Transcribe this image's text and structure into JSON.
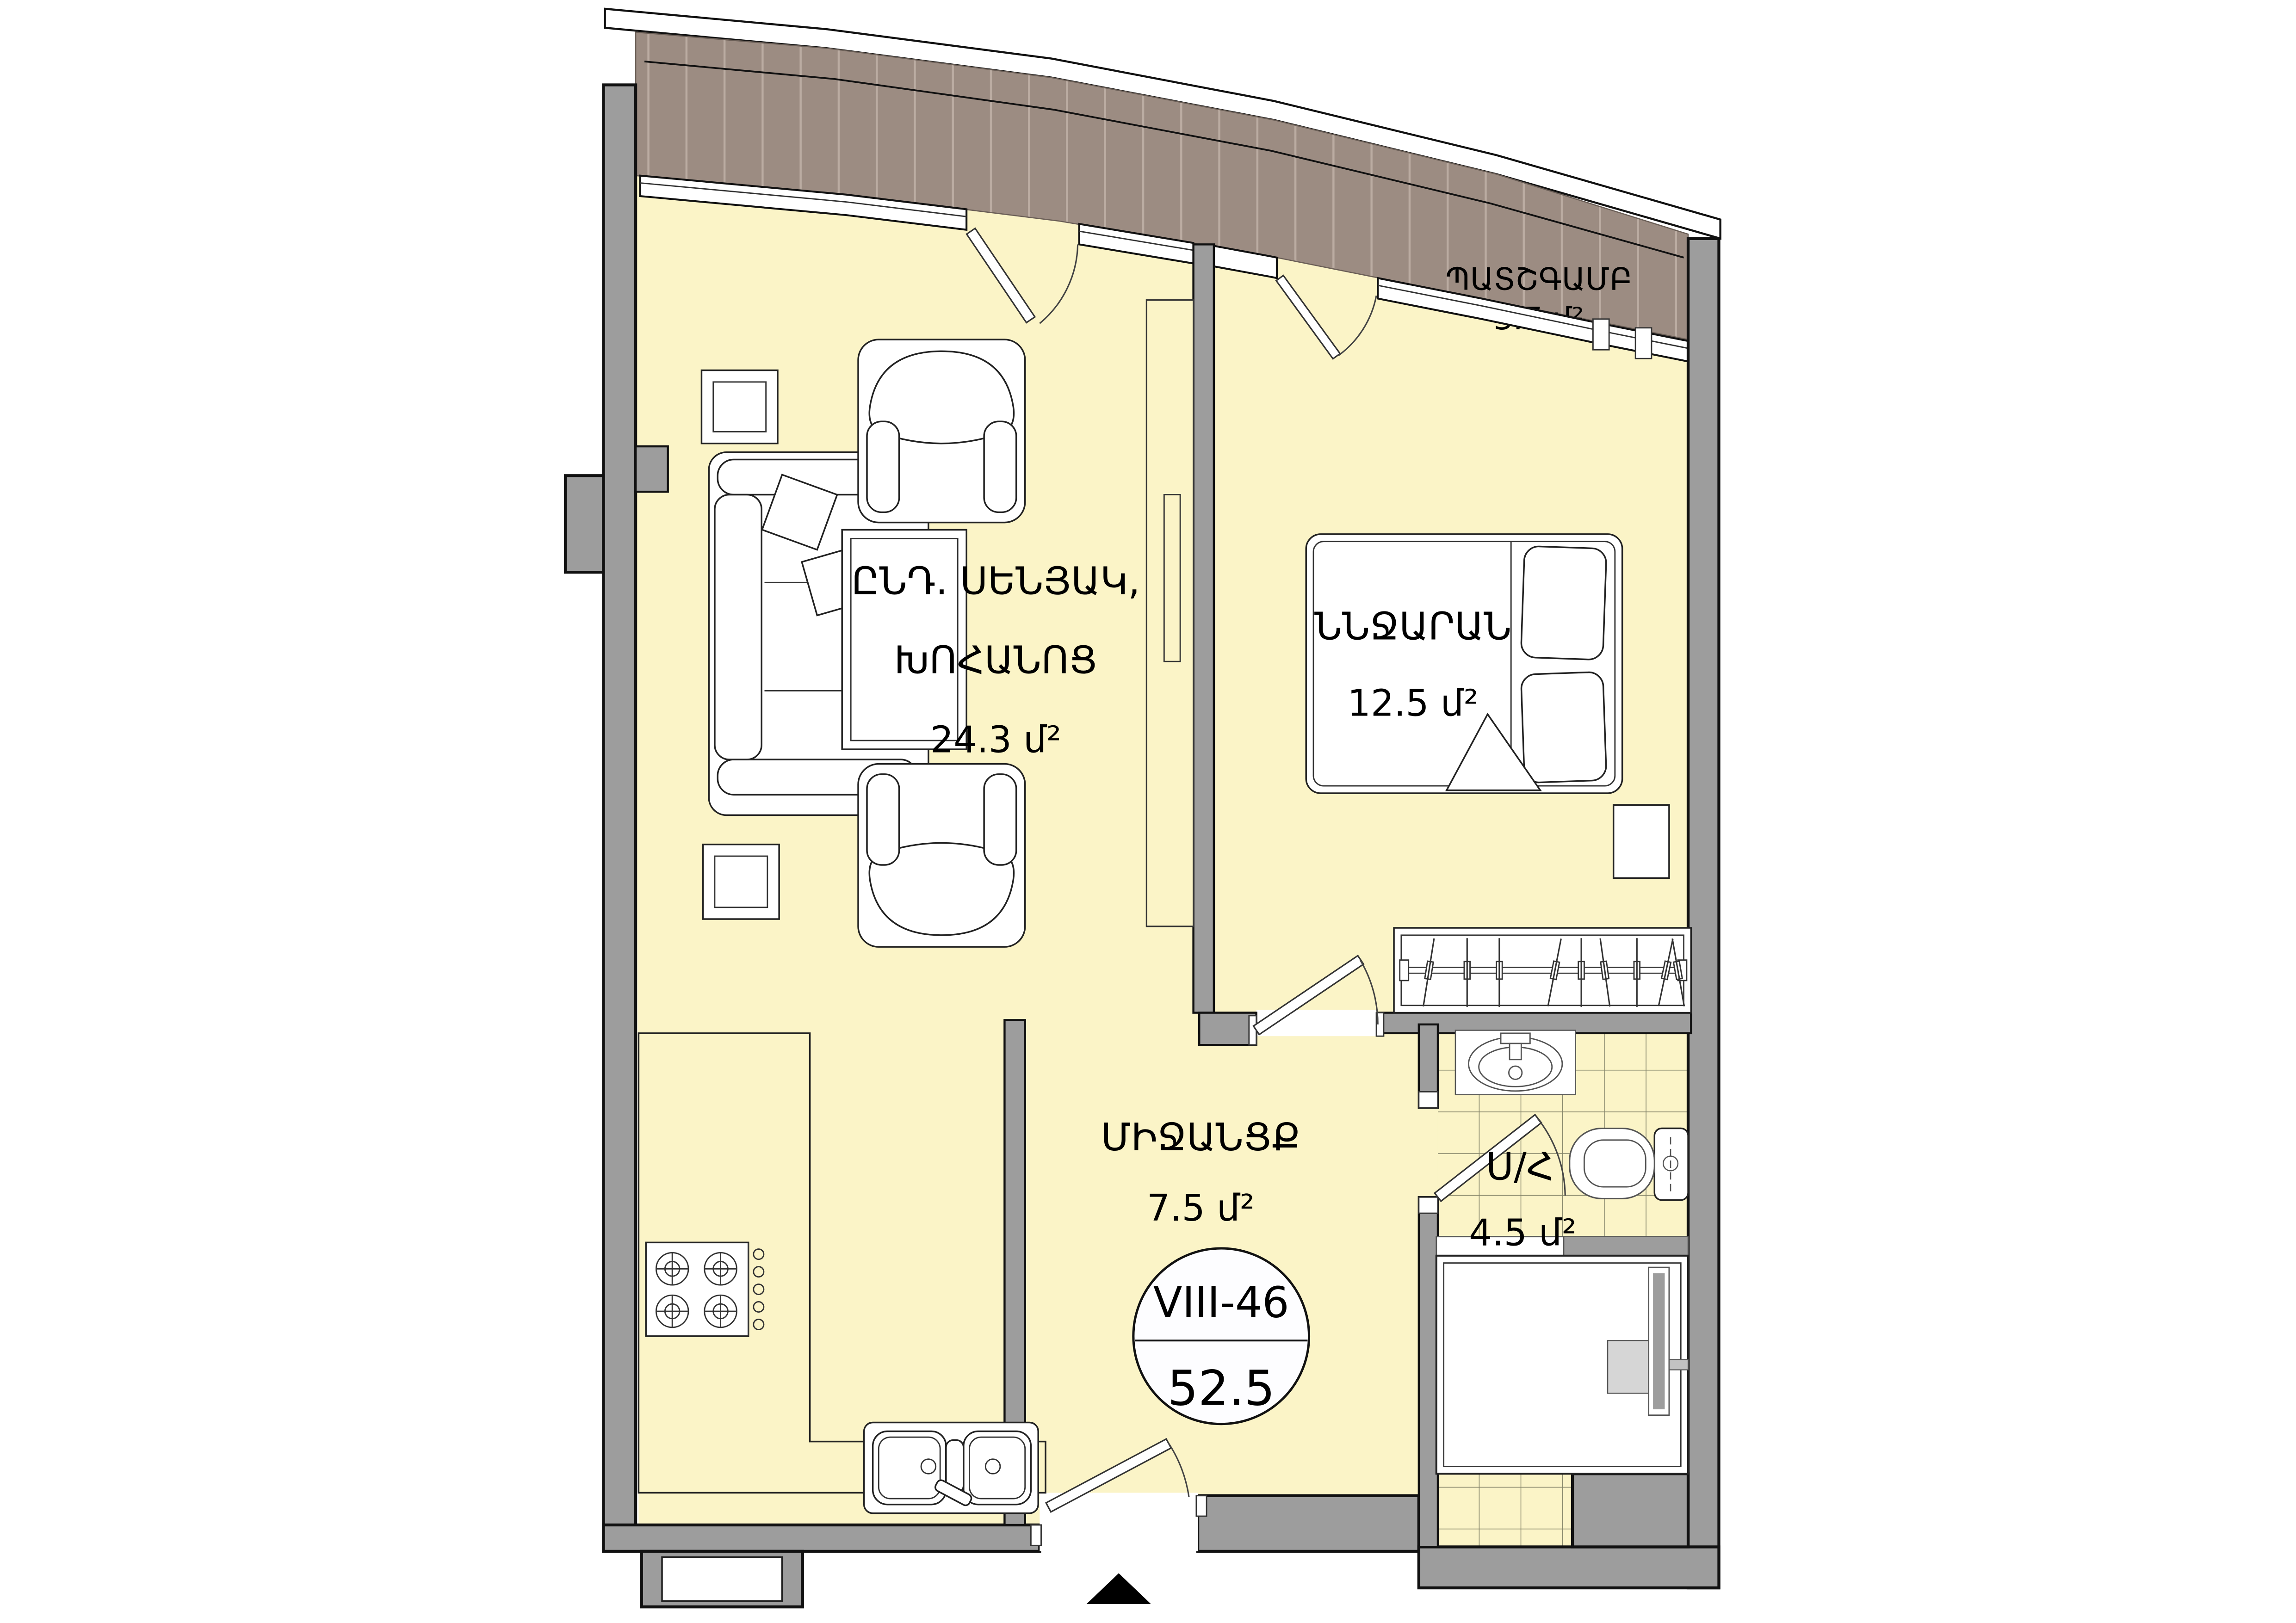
{
  "plan": {
    "title": "Apartment floor plan",
    "unit_badge": {
      "unit_id": "VIII-46",
      "total_area": "52.5"
    },
    "rooms": [
      {
        "id": "living_kitchen",
        "name_line1": "ԸՆԴ. ՍԵՆՅԱԿ,",
        "name_line2": "ԽՈՀԱՆՈՑ",
        "area": "24.3 մ²"
      },
      {
        "id": "bedroom",
        "name": "ՆՆՋԱՐԱՆ",
        "area": "12.5 մ²"
      },
      {
        "id": "hallway",
        "name": "ՄԻՋԱՆՑՔ",
        "area": "7.5 մ²"
      },
      {
        "id": "bathroom",
        "name": "Ս/Հ",
        "area": "4.5 մ²"
      },
      {
        "id": "balcony",
        "name": "ՊԱՏՇԳԱՄԲ",
        "area": "3.7 մ²"
      }
    ],
    "icons": [
      {
        "name": "north-entry-marker",
        "shape": "black-triangle"
      }
    ],
    "colors": {
      "floor": "#FBF4C7",
      "balcony_deck": "#9C8C82",
      "deck_plank_line": "#BBACA2",
      "wall": "#9D9D9D",
      "outline": "#111111",
      "tile_line": "#85856A",
      "fixture_gray": "#D6D6D6"
    }
  }
}
